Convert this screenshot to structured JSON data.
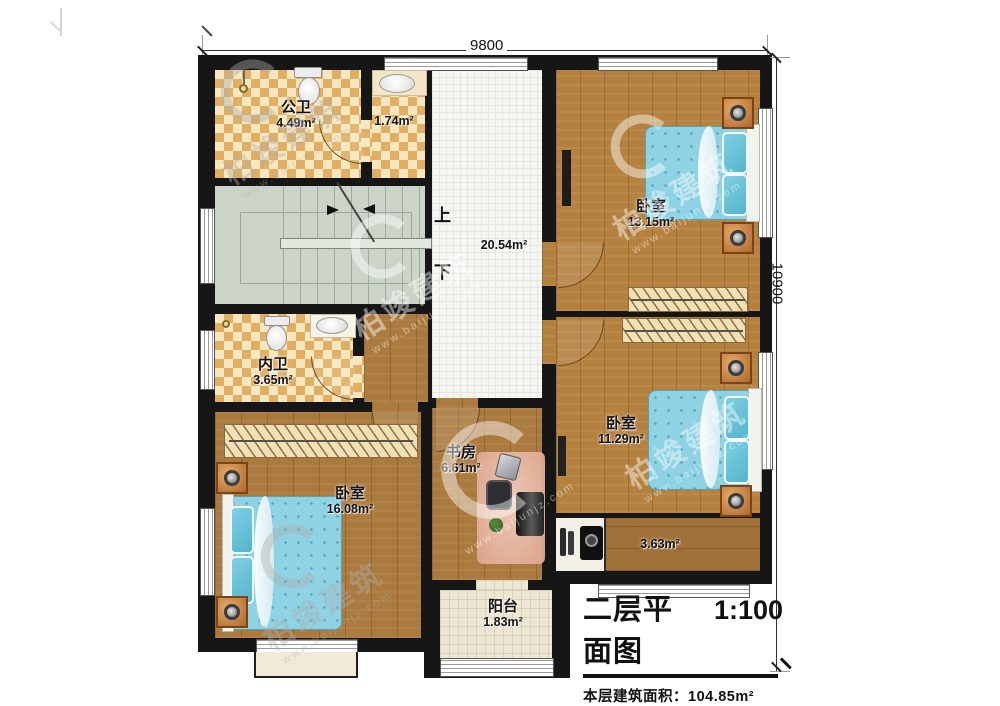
{
  "dimensions": {
    "width_label": "9800",
    "height_label": "10900"
  },
  "stair": {
    "up": "上",
    "down": "下"
  },
  "rooms": {
    "public_bath": {
      "name": "公卫",
      "area": "4.49m²"
    },
    "small_bath": {
      "area": "1.74m²"
    },
    "hallway": {
      "area": "20.54m²"
    },
    "bedroom_top_right": {
      "name": "卧室",
      "area": "13.15m²"
    },
    "inner_bath": {
      "name": "内卫",
      "area": "3.65m²"
    },
    "study": {
      "name": "书房",
      "area": "6.61m²"
    },
    "bedroom_right": {
      "name": "卧室",
      "area": "11.29m²"
    },
    "bedroom_bottom_left": {
      "name": "卧室",
      "area": "16.08m²"
    },
    "corridor": {
      "area": "3.63m²"
    },
    "balcony": {
      "name": "阳台",
      "area": "1.83m²"
    }
  },
  "title_block": {
    "title": "二层平面图",
    "scale": "1:100",
    "floor_area_label": "本层建筑面积：",
    "floor_area_value": "104.85m²",
    "floor_height_label": "层高：",
    "floor_height_value": "3.3m"
  },
  "watermark": {
    "brand": "柏竣建筑",
    "site": "www.baijunjz.com"
  },
  "colors": {
    "wall": "#161616",
    "wood": "#ab7a3e",
    "bath_tile": "#e2ae62",
    "stair": "#ccd4c9",
    "bed": "#8ed2e4",
    "copper": "#c5803f"
  }
}
